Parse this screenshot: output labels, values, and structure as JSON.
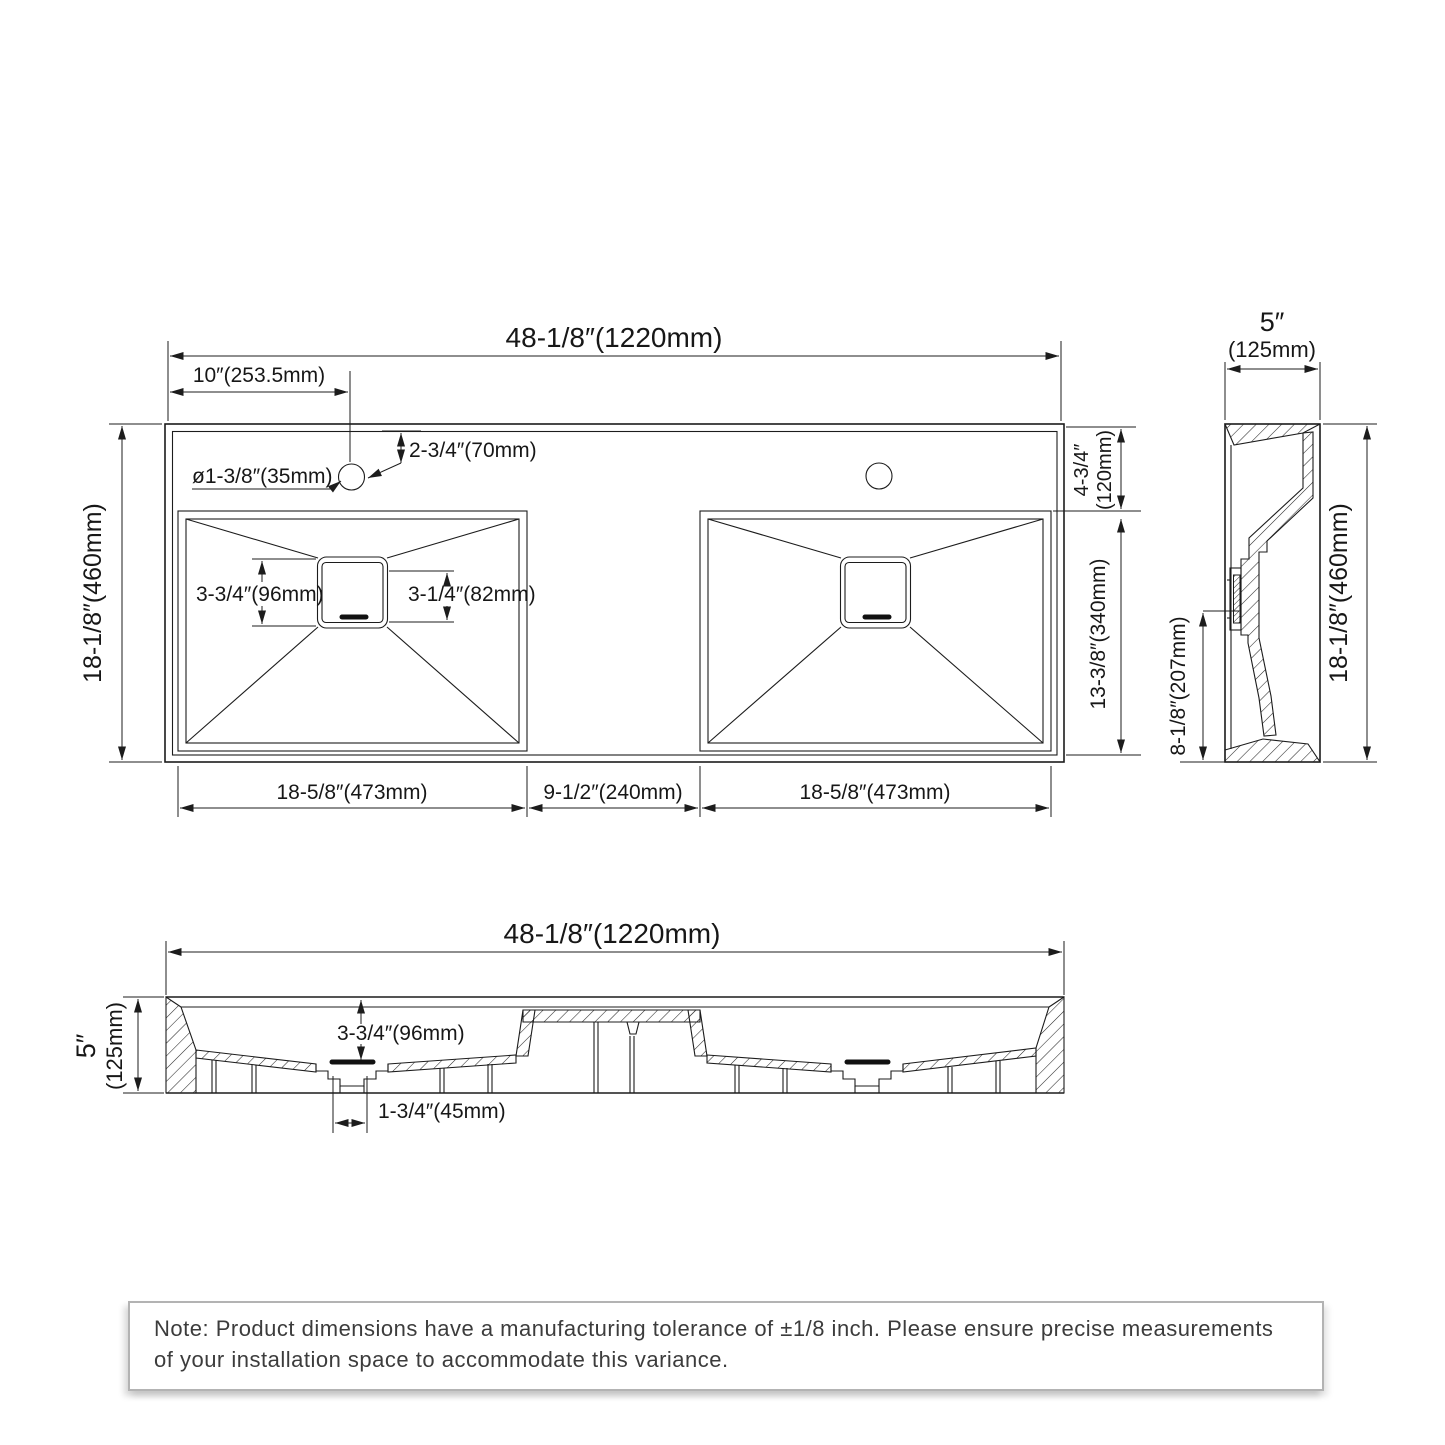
{
  "top_view": {
    "overall_width": "48-1/8″(1220mm)",
    "faucet_offset": "10″(253.5mm)",
    "faucet_setback": "2-3/4″(70mm)",
    "hole_diameter": "ø1-3/8″(35mm)",
    "overall_depth": "18-1/8″(460mm)",
    "drain_outer": "3-3/4″(96mm)",
    "drain_inner": "3-1/4″(82mm)",
    "deck_depth_in": "4-3/4″",
    "deck_depth_mm": "(120mm)",
    "basin_front_depth": "13-3/8″(340mm)",
    "left_basin_width": "18-5/8″(473mm)",
    "center_gap": "9-1/2″(240mm)",
    "right_basin_width": "18-5/8″(473mm)"
  },
  "side_view": {
    "width_in": "5″",
    "width_mm": "(125mm)",
    "height": "18-1/8″(460mm)",
    "drain_height": "8-1/8″(207mm)"
  },
  "front_view": {
    "overall_width": "48-1/8″(1220mm)",
    "height_in": "5″",
    "height_mm": "(125mm)",
    "basin_depth": "3-3/4″(96mm)",
    "drain_width": "1-3/4″(45mm)"
  },
  "note": {
    "text": "Note: Product dimensions have a manufacturing tolerance of ±1/8 inch. Please ensure precise measurements of your installation space to accommodate this variance."
  }
}
